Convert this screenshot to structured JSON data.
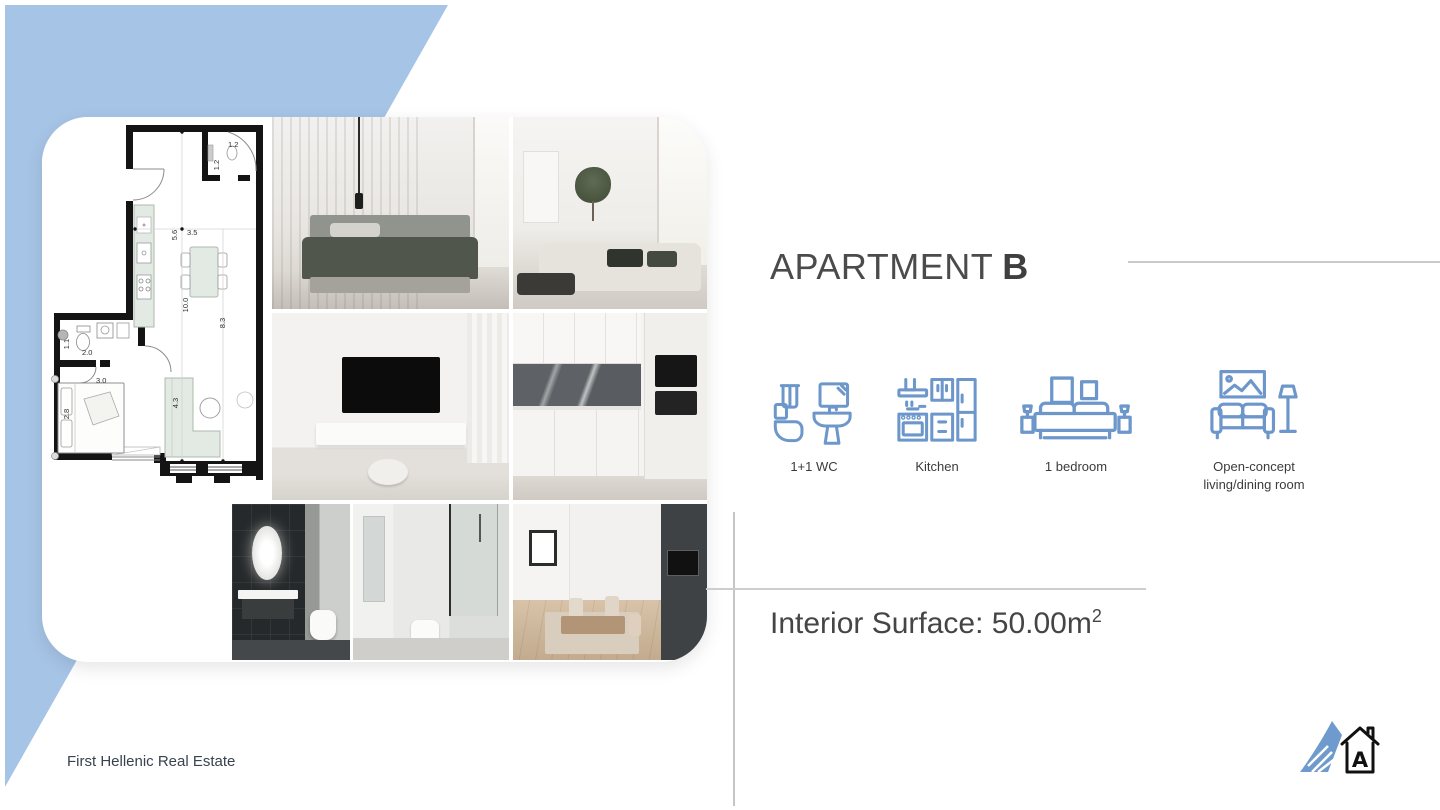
{
  "title": {
    "regular": "APARTMENT",
    "bold": "B"
  },
  "features": [
    {
      "icon": "wc-icon",
      "label": "1+1 WC"
    },
    {
      "icon": "kitchen-icon",
      "label": "Kitchen"
    },
    {
      "icon": "bedroom-icon",
      "label": "1 bedroom"
    },
    {
      "icon": "living-room-icon",
      "label": "Open-concept living/dining room"
    }
  ],
  "surface": {
    "text": "Interior Surface: 50.00m",
    "sup": "2"
  },
  "footer": {
    "text": "First Hellenic Real Estate"
  },
  "floorplan": {
    "dims": {
      "wc_top_w": "1.2",
      "wc_top_h": "1.2",
      "upper_len": "5.6",
      "living_w": "3.5",
      "total_len": "10.0",
      "living_len": "8.3",
      "bath_w": "1.1",
      "bath_len": "2.0",
      "bed_w": "3.0",
      "bed_len": "2.8",
      "sofa_wall": "4.3"
    }
  },
  "collage": {
    "photos": [
      "floor-plan",
      "bedroom",
      "living-room",
      "tv-wall",
      "kitchen",
      "dark-bathroom",
      "shower-bathroom",
      "dining-corridor"
    ]
  },
  "colors": {
    "accent_blue": "#a6c4e6",
    "icon_blue": "#6d97cb",
    "line_gray": "#c9c9c9",
    "title_gray": "#4b4b4b"
  }
}
